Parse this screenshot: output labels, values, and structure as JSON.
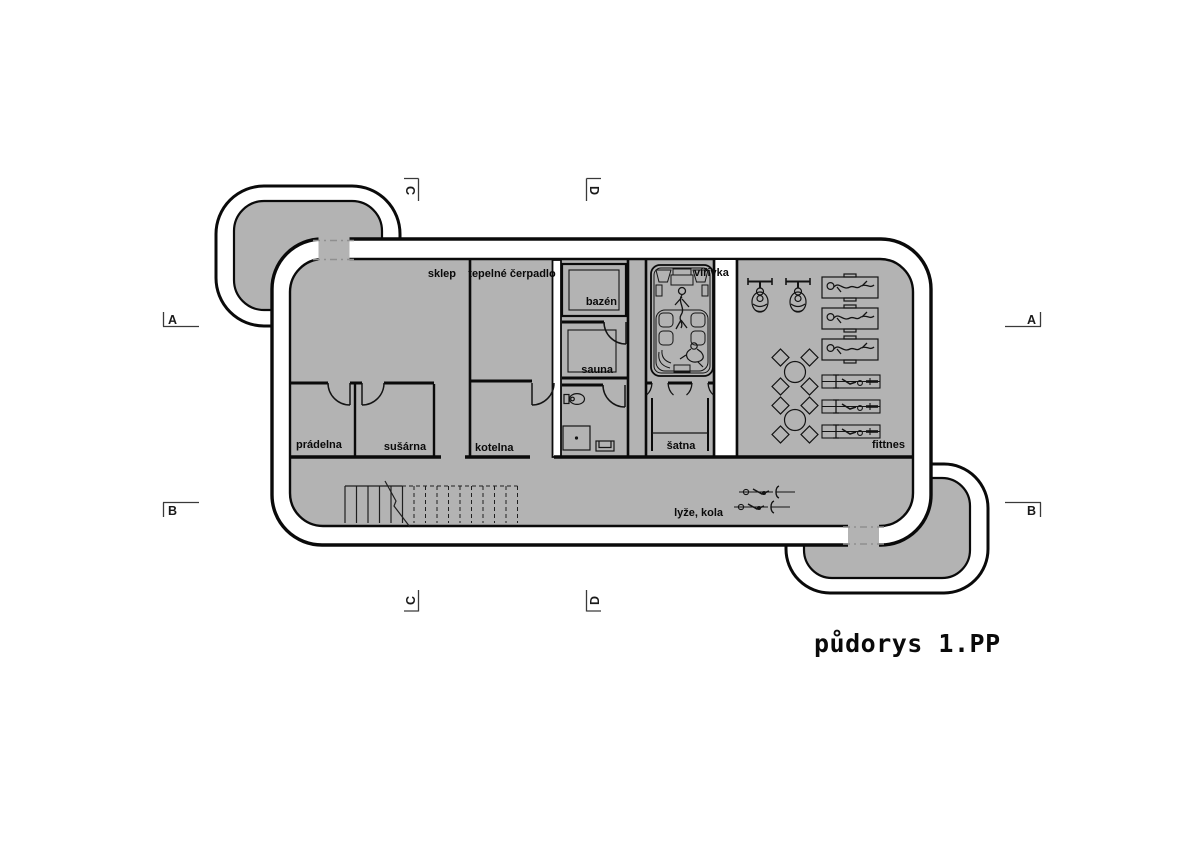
{
  "title": "půdorys 1.PP",
  "labels": {
    "sklep": "sklep",
    "tepelne_cerpadlo": "tepelné čerpadlo",
    "bazen": "bazén",
    "sauna": "sauna",
    "virivka": "vířivka",
    "pradelna": "prádelna",
    "susarna": "sušárna",
    "kotelna": "kotelna",
    "satna": "šatna",
    "fittnes": "fittnes",
    "lyze_kola": "lyže, kola"
  },
  "section_markers": {
    "a_left": "A",
    "a_right": "A",
    "b_left": "B",
    "b_right": "B",
    "c_top": "C",
    "c_bottom": "C",
    "d_top": "D",
    "d_bottom": "D"
  },
  "colors": {
    "floor": "#b3b3b3",
    "wall_fill": "#ffffff",
    "line": "#0a0a0a",
    "opening_dash": "#8f8f8f",
    "background": "#ffffff"
  }
}
